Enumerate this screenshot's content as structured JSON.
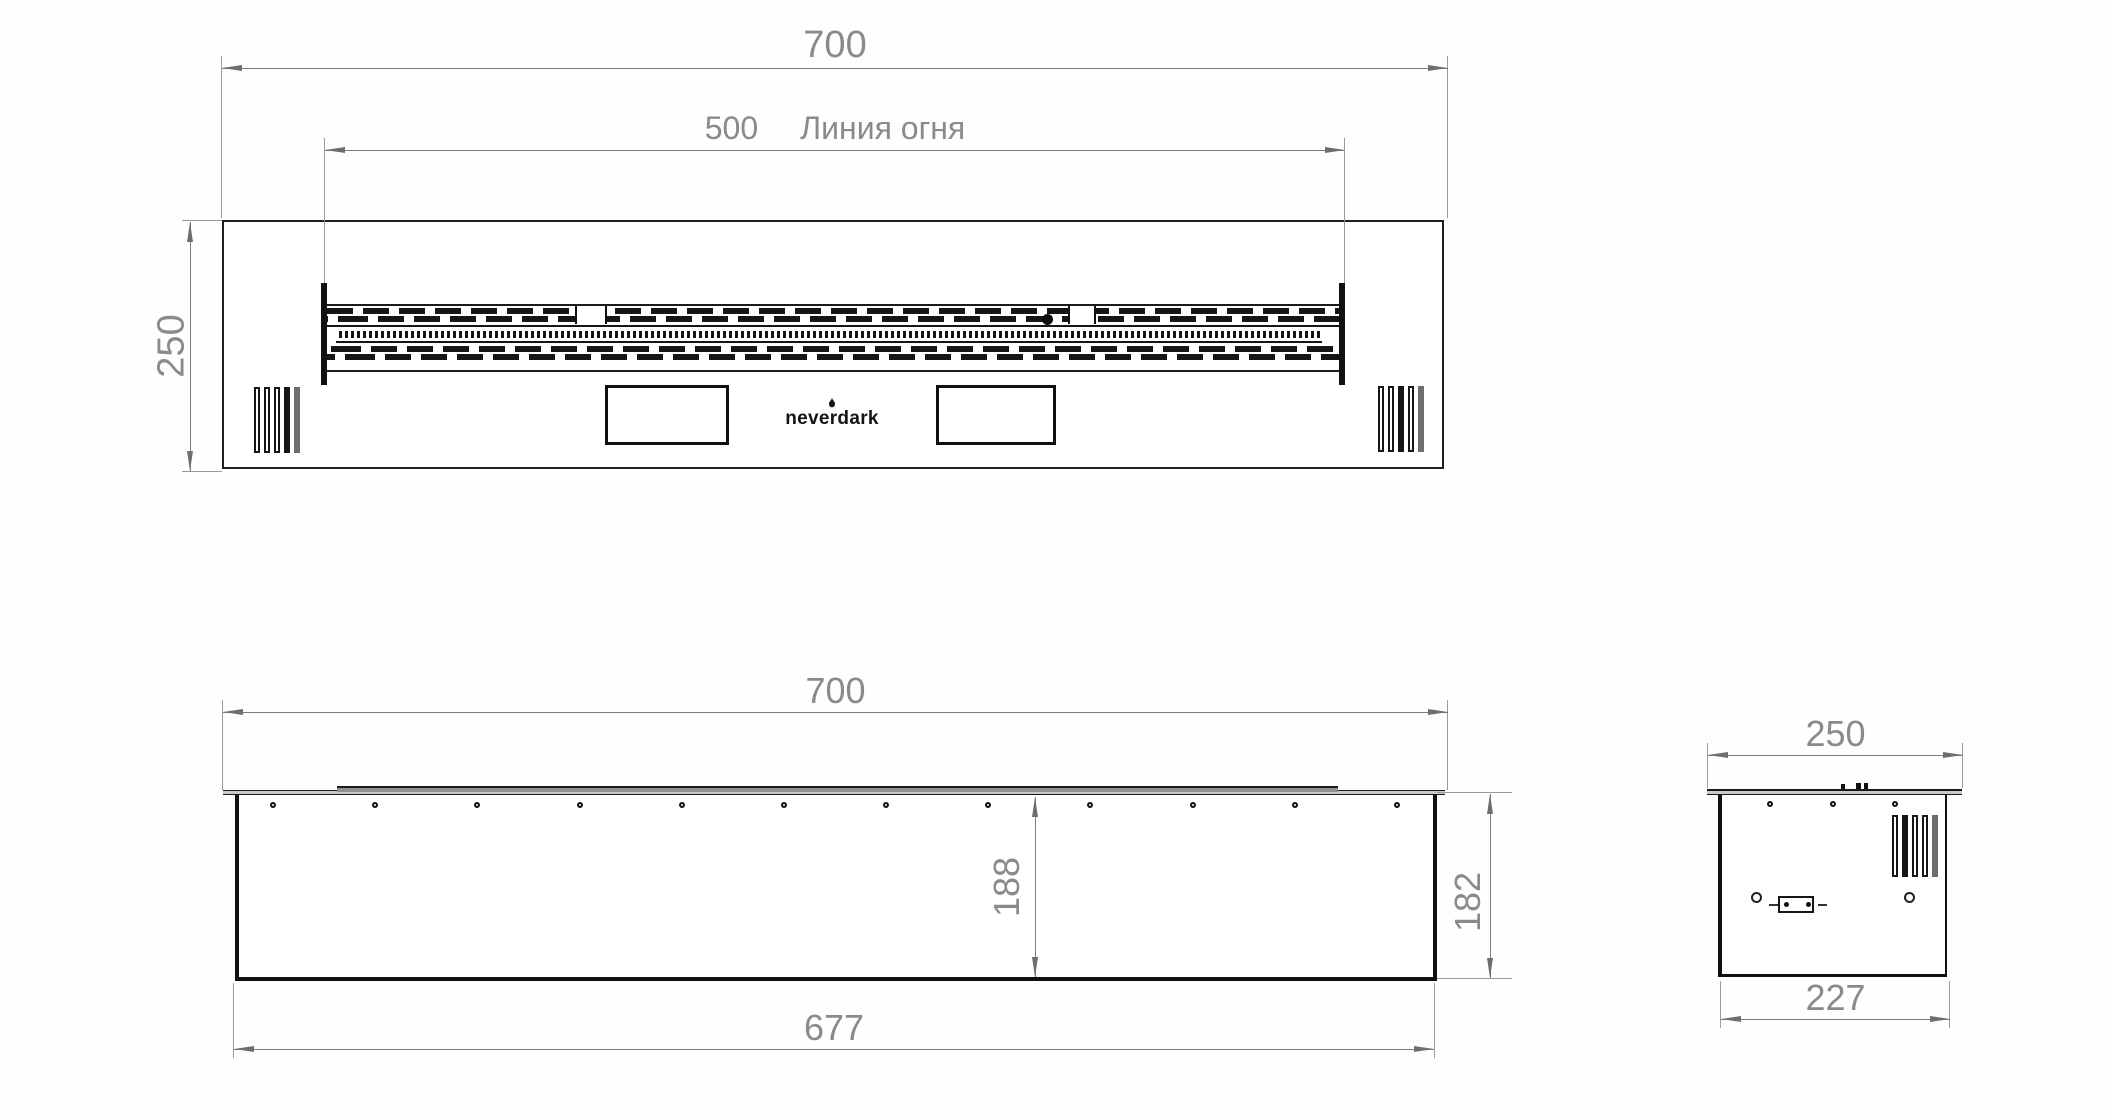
{
  "top_view": {
    "width_dim": "700",
    "fire_line_dim": "500",
    "fire_line_label": "Линия огня",
    "depth_dim": "250",
    "brand_logo": "neverdark"
  },
  "front_view": {
    "width_dim": "700",
    "inner_height_dim": "188",
    "body_height_dim": "182",
    "bottom_width_dim": "677"
  },
  "side_view": {
    "depth_dim": "250",
    "bottom_depth_dim": "227"
  },
  "colors": {
    "edge": "#1a1a1a",
    "dimension_line": "#7d7d7d",
    "dimension_text": "#8a8a8a"
  }
}
